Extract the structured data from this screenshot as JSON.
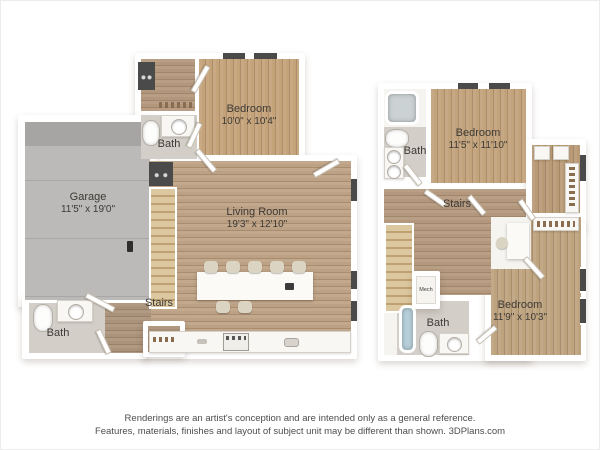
{
  "floor1": {
    "garage": {
      "name": "Garage",
      "dims": "11'5\" x 19'0\""
    },
    "bedroom": {
      "name": "Bedroom",
      "dims": "10'0\" x 10'4\""
    },
    "living": {
      "name": "Living Room",
      "dims": "19'3\" x 12'10\""
    },
    "bath_upper": {
      "label": "Bath"
    },
    "bath_lower": {
      "label": "Bath"
    },
    "stairs": {
      "label": "Stairs"
    }
  },
  "floor2": {
    "bedroom_upper": {
      "name": "Bedroom",
      "dims": "11'5\" x 11'10\""
    },
    "bedroom_lower": {
      "name": "Bedroom",
      "dims": "11'9\" x 10'3\""
    },
    "bath_upper": {
      "label": "Bath"
    },
    "bath_lower": {
      "label": "Bath"
    },
    "stairs": {
      "label": "Stairs"
    },
    "mech": {
      "label": "Mech"
    }
  },
  "disclaimer": {
    "line1": "Renderings are an artist's conception and are intended only as a general reference.",
    "line2": "Features, materials, finishes and layout of subject unit may be different than shown. 3DPlans.com"
  },
  "colors": {
    "wood_living": "#bda184",
    "wood_bedroom": "#c4a37a",
    "wood_hall": "#b2977c",
    "stairs_wood": "#dcc8a0",
    "garage_concrete": "#bbbab8",
    "bath_floor": "#d3cfc8",
    "wall": "#ffffff",
    "window_bar": "#4a4a4a",
    "label_text": "#3c3935"
  }
}
